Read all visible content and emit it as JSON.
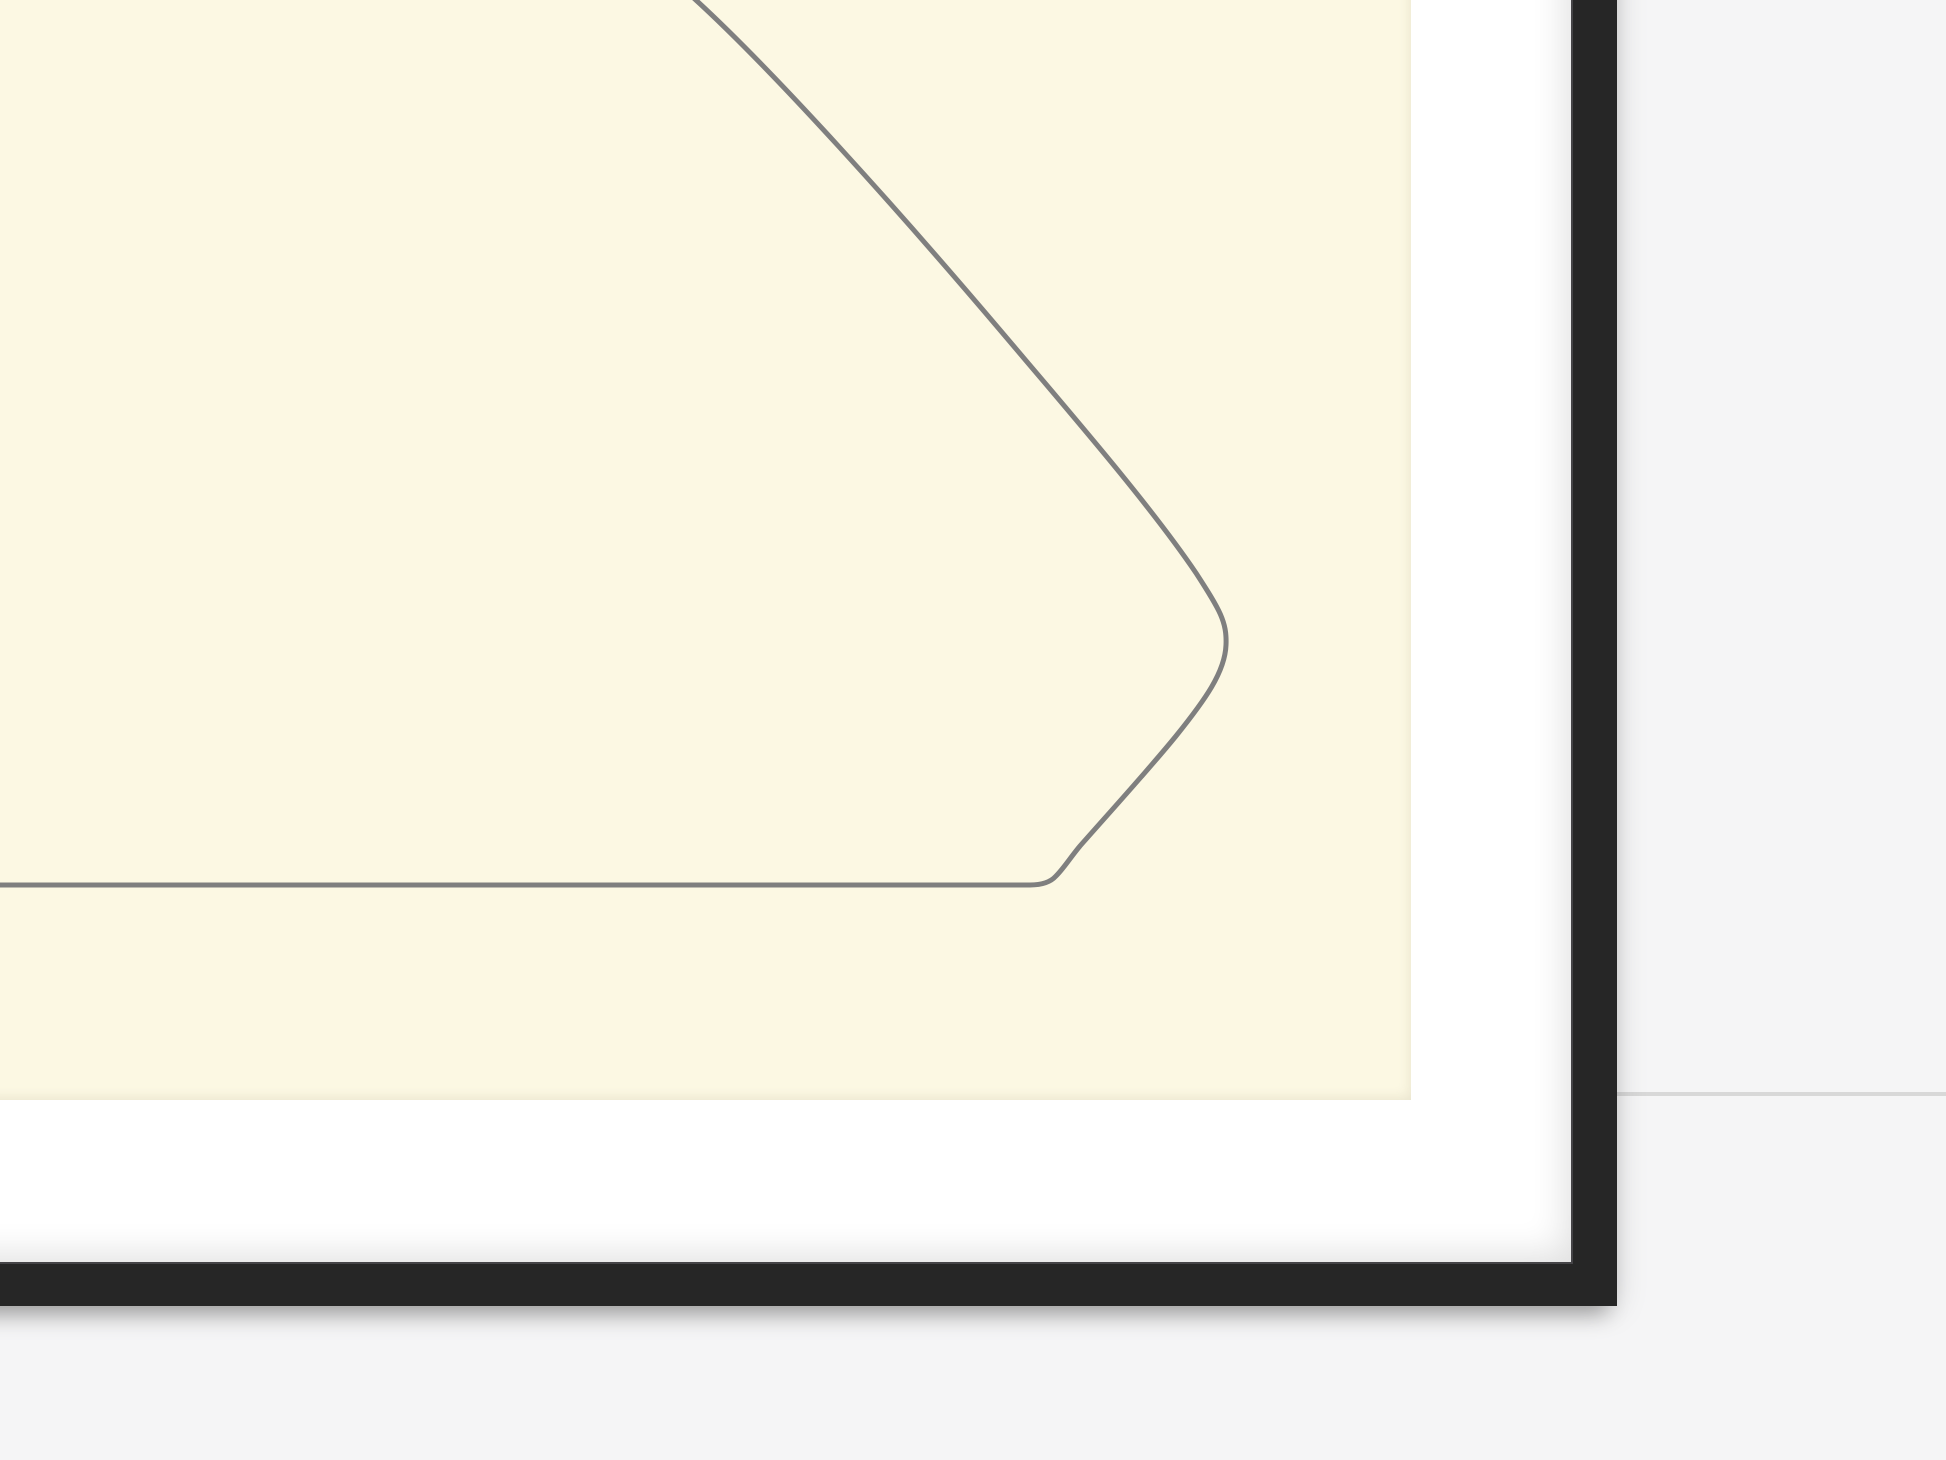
{
  "colors": {
    "wall": "#f5f5f6",
    "wall_seam": "#d8d8d8",
    "frame": "#262626",
    "frame_inner_lip": "#454447",
    "mat": "#ffffff",
    "paper": "#fcf8e3",
    "line": "#7f7f7f"
  },
  "artwork": {
    "stroke_width": 5,
    "path": "M 687 -8 C 770 66 905 218 1000 330 C 1072 415 1150 505 1196 573 C 1220 610 1227 622 1226 645 C 1225 672 1205 700 1176 736 C 1150 768 1110 812 1080 846 C 1070 858 1064 868 1056 876 Q 1048 885 1030 885 L -12 885"
  }
}
